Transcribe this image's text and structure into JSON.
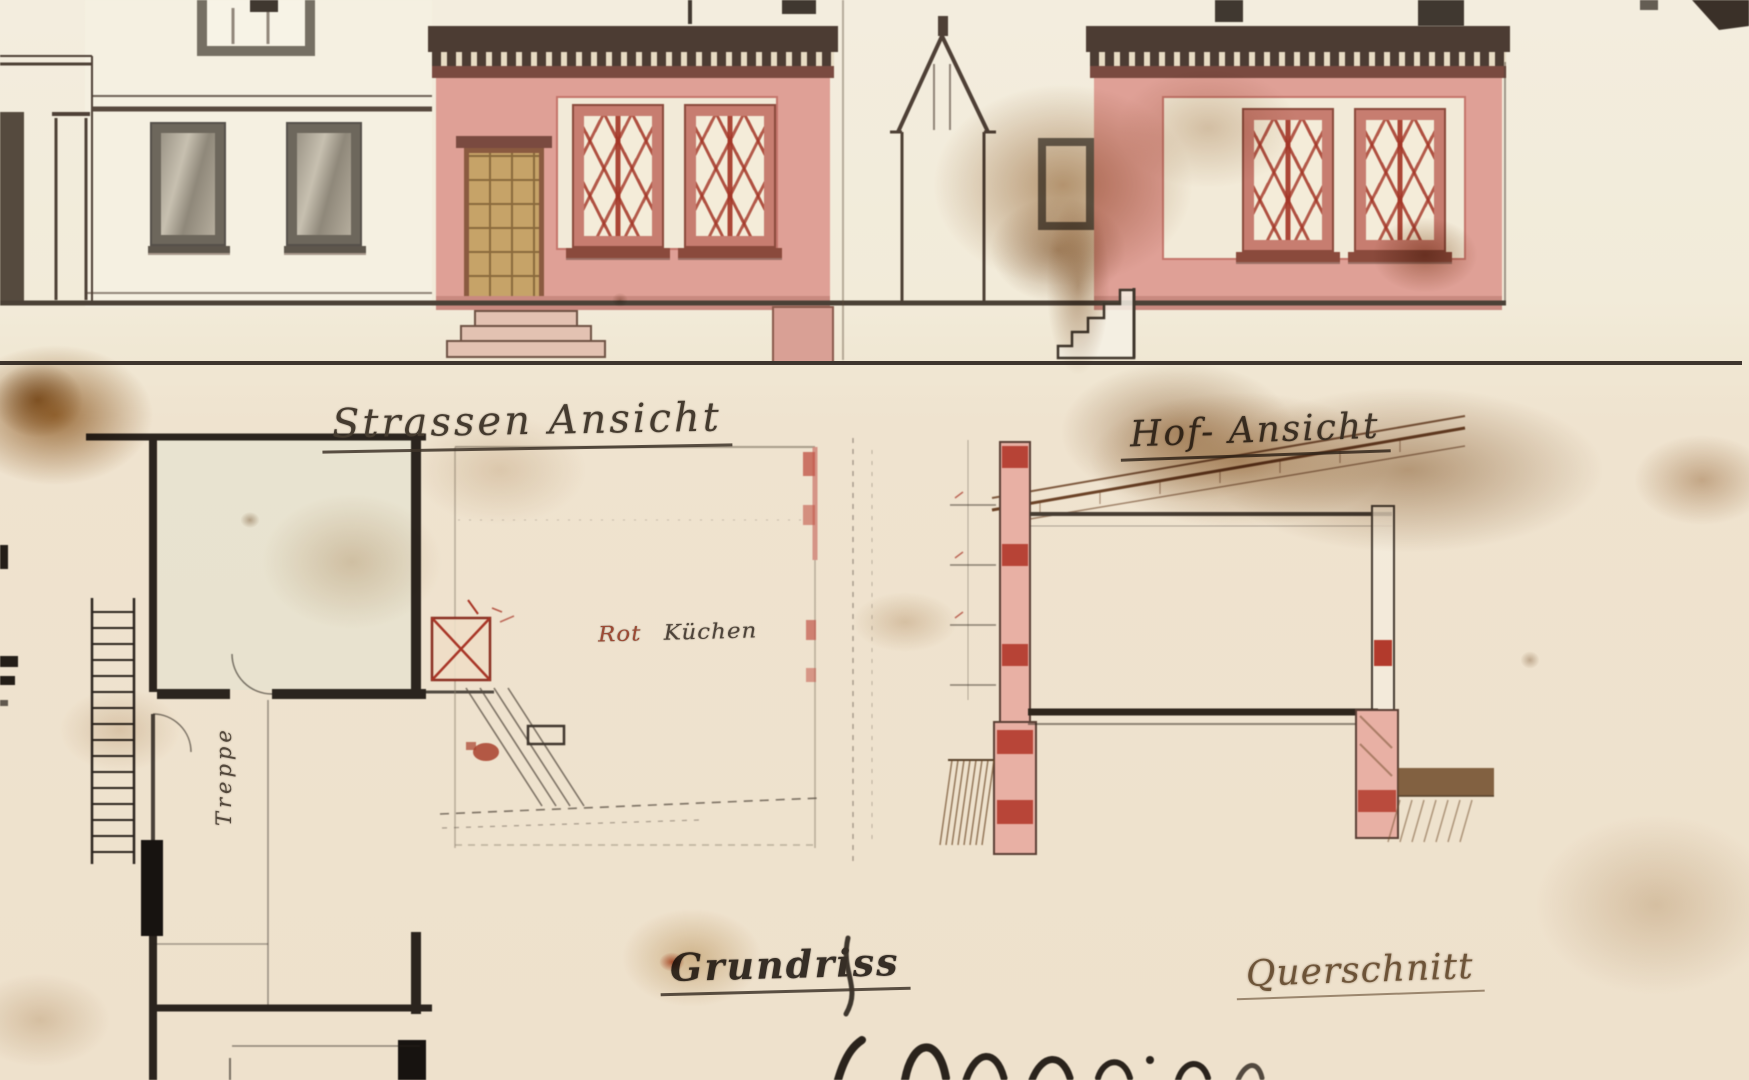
{
  "labels": {
    "street_elevation": "Strassen Ansicht",
    "courtyard_elevation": "Hof- Ansicht",
    "floor_plan": "Grundriss",
    "cross_section": "Querschnitt",
    "plan_note_word1": "Rot",
    "plan_note_word2": "Küchen",
    "stair_note": "Treppe"
  },
  "palette": {
    "paper": "#f1ead8",
    "paper_lower": "#efe3d0",
    "ink": "#45392f",
    "facade_pink": "#dfa096",
    "facade_trim": "#c77d70",
    "cornice": "#4c3c33",
    "lattice_red": "#a33526",
    "door_wood": "#c6a368",
    "section_red": "#b23a2c",
    "stain_brown": "#8a5a28",
    "hatch_brown": "#6e4a28"
  }
}
